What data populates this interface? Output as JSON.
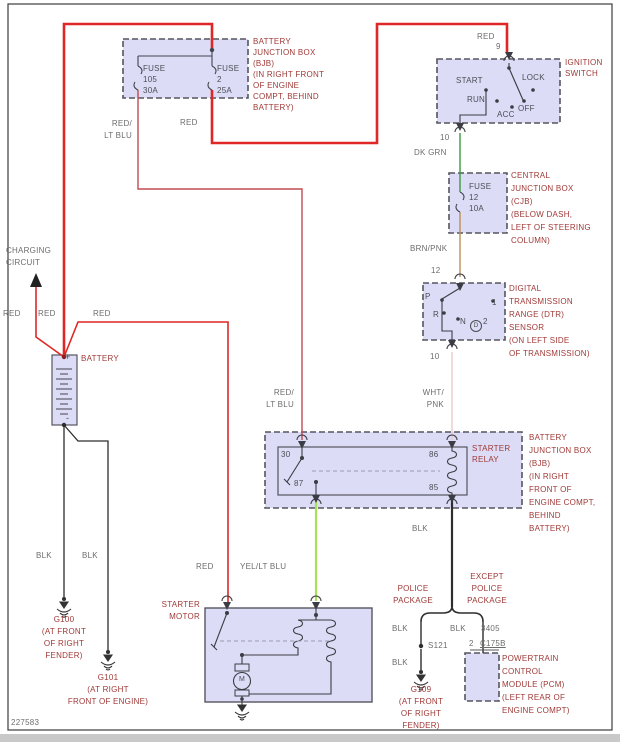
{
  "page": {
    "doc_number": "227583"
  },
  "colors": {
    "wire_red": "#de2726",
    "wire_red_lt_blu": "#c24b52",
    "wire_dk_grn": "#3a9a3c",
    "wire_brn_pnk": "#b98e57",
    "wire_wht_pnk": "#eccaca",
    "wire_yel_lt_blu": "#a9e156",
    "wire_blk": "#2d2d2d",
    "box_fill": "#dcdcf6",
    "box_stroke": "#55555f",
    "label_component": "#a03a38",
    "label_wire": "#6d6d6d",
    "label_inner": "#4c4c55"
  },
  "wire_labels": {
    "red": "RED",
    "red_lt_blu": [
      "RED/",
      "LT BLU"
    ],
    "dk_grn": "DK GRN",
    "brn_pnk": "BRN/PNK",
    "wht_pnk": [
      "WHT/",
      "PNK"
    ],
    "yel_lt_blu": "YEL/LT BLU",
    "blk": "BLK"
  },
  "charging_circuit": [
    "CHARGING",
    "CIRCUIT"
  ],
  "bjb_top": {
    "label": [
      "BATTERY",
      "JUNCTION BOX",
      "(BJB)",
      "(IN RIGHT FRONT",
      "OF ENGINE",
      "COMPT, BEHIND",
      "BATTERY)"
    ],
    "fuse_105": [
      "FUSE",
      "105",
      "30A"
    ],
    "fuse_2": [
      "FUSE",
      "2",
      "25A"
    ]
  },
  "ignition": {
    "label": [
      "IGNITION",
      "SWITCH"
    ],
    "terminal_in": "9",
    "terminal_out": "10",
    "positions": {
      "start": "START",
      "run": "RUN",
      "acc": "ACC",
      "off": "OFF",
      "lock": "LOCK"
    }
  },
  "cjb": {
    "label": [
      "CENTRAL",
      "JUNCTION BOX",
      "(CJB)",
      "(BELOW DASH,",
      "LEFT OF STEERING",
      "COLUMN)"
    ],
    "fuse_12": [
      "FUSE",
      "12",
      "10A"
    ]
  },
  "dtr": {
    "label": [
      "DIGITAL",
      "TRANSMISSION",
      "RANGE (DTR)",
      "SENSOR",
      "(ON LEFT SIDE",
      "OF TRANSMISSION)"
    ],
    "terminal_in": "12",
    "terminal_out": "10",
    "positions": {
      "p": "P",
      "r": "R",
      "n": "N",
      "d": "D",
      "two": "2",
      "one": "1"
    }
  },
  "relay_box": {
    "label": [
      "BATTERY",
      "JUNCTION BOX",
      "(BJB)",
      "(IN RIGHT",
      "FRONT OF",
      "ENGINE COMPT,",
      "BEHIND",
      "BATTERY)"
    ],
    "relay": [
      "STARTER",
      "RELAY"
    ],
    "t30": "30",
    "t87": "87",
    "t86": "86",
    "t85": "85"
  },
  "battery": {
    "label": "BATTERY",
    "plus": "+",
    "minus": "-"
  },
  "starter_motor": {
    "label": [
      "STARTER",
      "MOTOR"
    ],
    "motor": "M"
  },
  "grounds": {
    "g100": {
      "name": "G100",
      "loc": [
        "(AT FRONT",
        "OF RIGHT",
        "FENDER)"
      ]
    },
    "g101": {
      "name": "G101",
      "loc": [
        "(AT RIGHT",
        "FRONT OF ENGINE)"
      ]
    },
    "g109": {
      "name": "G109",
      "loc": [
        "(AT FRONT",
        "OF RIGHT",
        "FENDER)"
      ]
    }
  },
  "branches": {
    "police": [
      "POLICE",
      "PACKAGE"
    ],
    "except": [
      "EXCEPT",
      "POLICE",
      "PACKAGE"
    ],
    "splice": "S121",
    "circuit": "3405",
    "pin": "2",
    "connector": "C175B"
  },
  "pcm": {
    "label": [
      "POWERTRAIN",
      "CONTROL",
      "MODULE (PCM)",
      "(LEFT REAR OF",
      "ENGINE COMPT)"
    ]
  }
}
